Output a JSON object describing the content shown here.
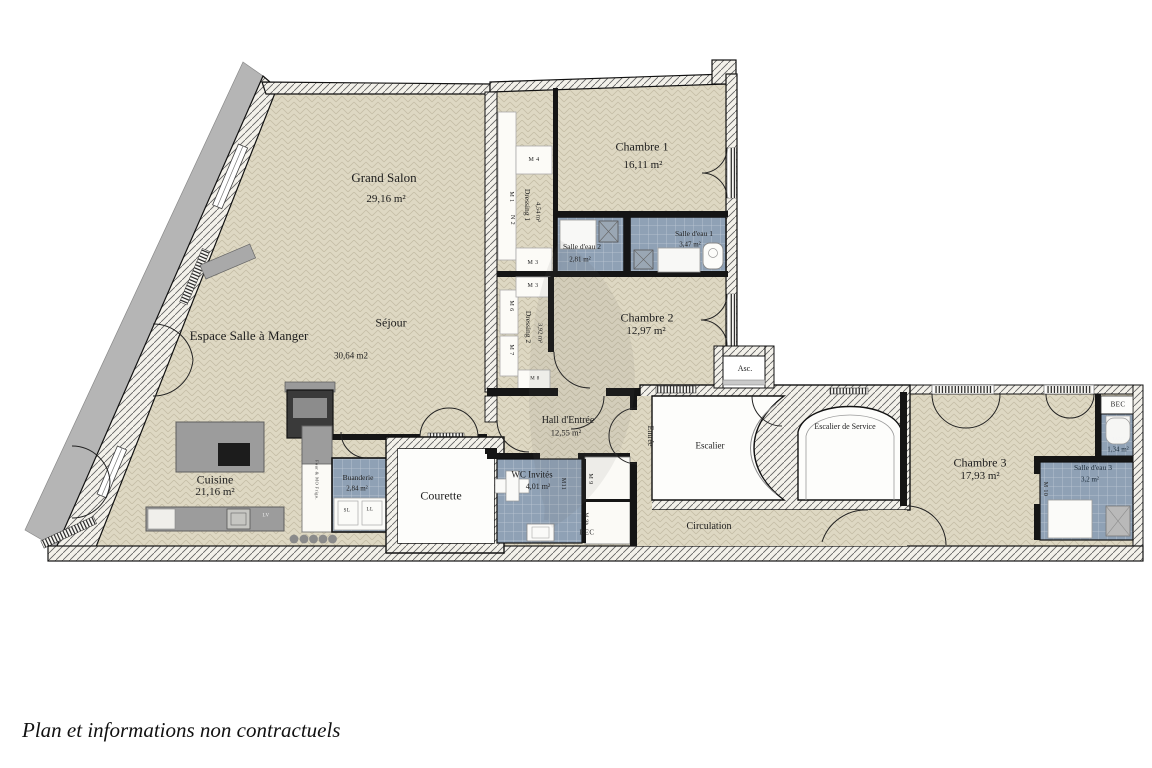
{
  "footer": "Plan et informations non contractuels",
  "rooms": {
    "grand_salon": {
      "name": "Grand Salon",
      "area": "29,16 m²"
    },
    "chambre1": {
      "name": "Chambre 1",
      "area": "16,11 m²"
    },
    "dressing1": {
      "name": "Dressing 1",
      "area": "4,54 m²"
    },
    "salle_eau2": {
      "name": "Salle d'eau 2",
      "area": "2,81 m²"
    },
    "salle_eau1": {
      "name": "Salle d'eau 1",
      "area": "3,47 m²"
    },
    "chambre2": {
      "name": "Chambre 2",
      "area": "12,97 m²"
    },
    "dressing2": {
      "name": "Dressing 2",
      "area": "3,92 m²"
    },
    "salle_a_manger": {
      "name": "Espace Salle à Manger"
    },
    "sejour": {
      "name": "Séjour",
      "area": "30,64 m2"
    },
    "cuisine": {
      "name": "Cuisine",
      "area": "21,16 m²"
    },
    "buanderie": {
      "name": "Buanderie",
      "area": "2,84 m²"
    },
    "courette": {
      "name": "Courette"
    },
    "hall": {
      "name": "Hall d'Entrée",
      "area": "12,55 m²"
    },
    "wc_invites": {
      "name": "WC Invités",
      "area": "4,01 m²"
    },
    "entree": {
      "name": "Entrée"
    },
    "escalier": {
      "name": "Escalier"
    },
    "ascenseur": {
      "name": "Asc."
    },
    "escalier_service": {
      "name": "Escalier de Service"
    },
    "circulation": {
      "name": "Circulation"
    },
    "chambre3": {
      "name": "Chambre 3",
      "area": "17,93 m²"
    },
    "wc": {
      "name": "WC",
      "area": "1,34 m²"
    },
    "salle_eau3": {
      "name": "Salle d'eau 3",
      "area": "3,2 m²"
    }
  },
  "tags": {
    "m4": "M 4",
    "m1": "M 1",
    "n2": "N 2",
    "m3_top": "M 3",
    "m3_mid": "M 3",
    "m6": "M 6",
    "m7": "M 7",
    "m8": "M 8",
    "m11": "M11",
    "m9_top": "M 9",
    "m9_bottom": "M 9b",
    "bec_hall": "BEC",
    "bec_wc": "BEC",
    "m10": "M 10",
    "sl": "SL",
    "ll": "LL",
    "lv": "LV",
    "appliances": "Four & MO  Frigo."
  },
  "colors": {
    "floor_parquet": "#ded8c3",
    "wet_room_blue": "#8fa1b5",
    "wall_black": "#151515",
    "terrace_gray": "#b5b5b5"
  }
}
